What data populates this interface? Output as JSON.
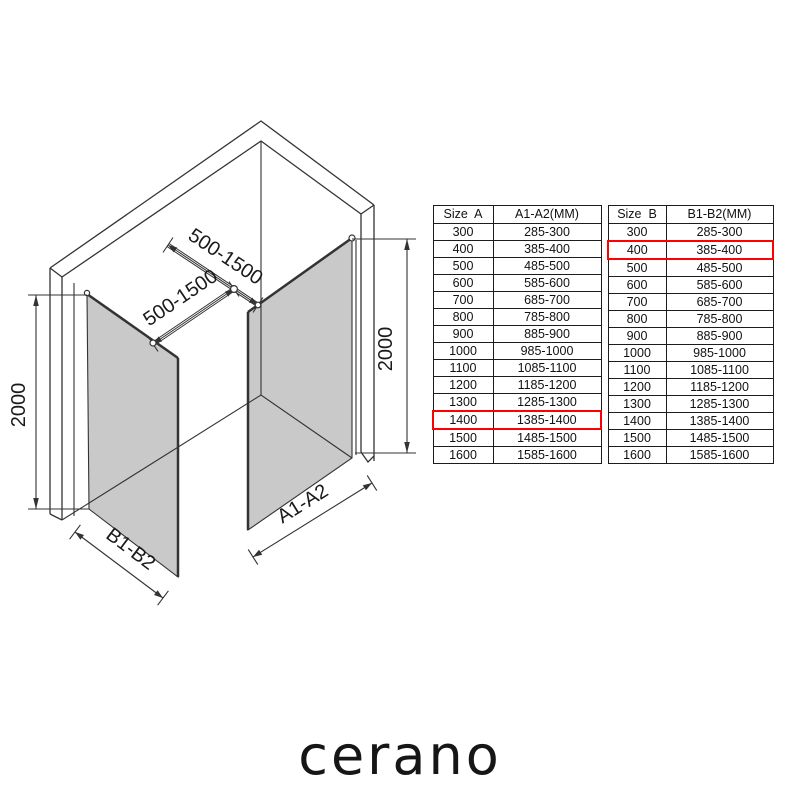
{
  "diagram": {
    "bar_top_label": "500-1500",
    "bar_bottom_label": "500-1500",
    "height_left_label": "2000",
    "height_right_label": "2000",
    "width_b_label": "B1-B2",
    "width_a_label": "A1-A2"
  },
  "tables": [
    {
      "id": "size-a",
      "headers": [
        "Size  A",
        "A1-A2(MM)"
      ],
      "rows": [
        [
          "300",
          "285-300"
        ],
        [
          "400",
          "385-400"
        ],
        [
          "500",
          "485-500"
        ],
        [
          "600",
          "585-600"
        ],
        [
          "700",
          "685-700"
        ],
        [
          "800",
          "785-800"
        ],
        [
          "900",
          "885-900"
        ],
        [
          "1000",
          "985-1000"
        ],
        [
          "1100",
          "1085-1100"
        ],
        [
          "1200",
          "1185-1200"
        ],
        [
          "1300",
          "1285-1300"
        ],
        [
          "1400",
          "1385-1400"
        ],
        [
          "1500",
          "1485-1500"
        ],
        [
          "1600",
          "1585-1600"
        ]
      ],
      "highlight_row": "1400"
    },
    {
      "id": "size-b",
      "headers": [
        "Size  B",
        "B1-B2(MM)"
      ],
      "rows": [
        [
          "300",
          "285-300"
        ],
        [
          "400",
          "385-400"
        ],
        [
          "500",
          "485-500"
        ],
        [
          "600",
          "585-600"
        ],
        [
          "700",
          "685-700"
        ],
        [
          "800",
          "785-800"
        ],
        [
          "900",
          "885-900"
        ],
        [
          "1000",
          "985-1000"
        ],
        [
          "1100",
          "1085-1100"
        ],
        [
          "1200",
          "1185-1200"
        ],
        [
          "1300",
          "1285-1300"
        ],
        [
          "1400",
          "1385-1400"
        ],
        [
          "1500",
          "1485-1500"
        ],
        [
          "1600",
          "1585-1600"
        ]
      ],
      "highlight_row": "400"
    }
  ],
  "logo_text": "cerano",
  "colors": {
    "highlight_box": "#ff0000",
    "glass_fill": "#c9c9c9",
    "line": "#333333"
  }
}
